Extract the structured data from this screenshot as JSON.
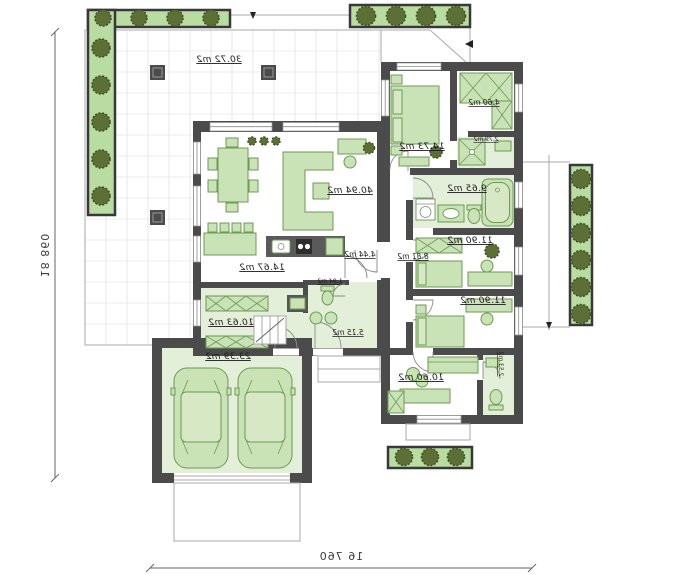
{
  "labels": {
    "terrace": "30.72 m2",
    "living_room": "40.94 m2",
    "kitchen": "14.67 m2",
    "hall": "10.63 m2",
    "entrance": "5.15 m2",
    "wc": "1.94 m2",
    "hallway": "4.44 m2",
    "corridor": "8.81 m2",
    "garage": "23.39 m2",
    "master_bedroom": "14.73 m2",
    "wardrobe": "4.60 m2",
    "bathroom_small": "2.79 m2",
    "bathroom": "9.65 m2",
    "bedroom_1": "11.90 m2",
    "bedroom_2": "11.90 m2",
    "office": "10.60 m2",
    "wc_2": "2.53 m2"
  },
  "dimensions": {
    "height": "18 860",
    "width": "16 760"
  },
  "colors": {
    "wall": "#4b4b4b",
    "furniture": "#c9e2b6",
    "furniture_stroke": "#6d9a55",
    "floor_tint": "#e4efd9",
    "planter": "#b9dca3",
    "bush": "#5c7036"
  }
}
